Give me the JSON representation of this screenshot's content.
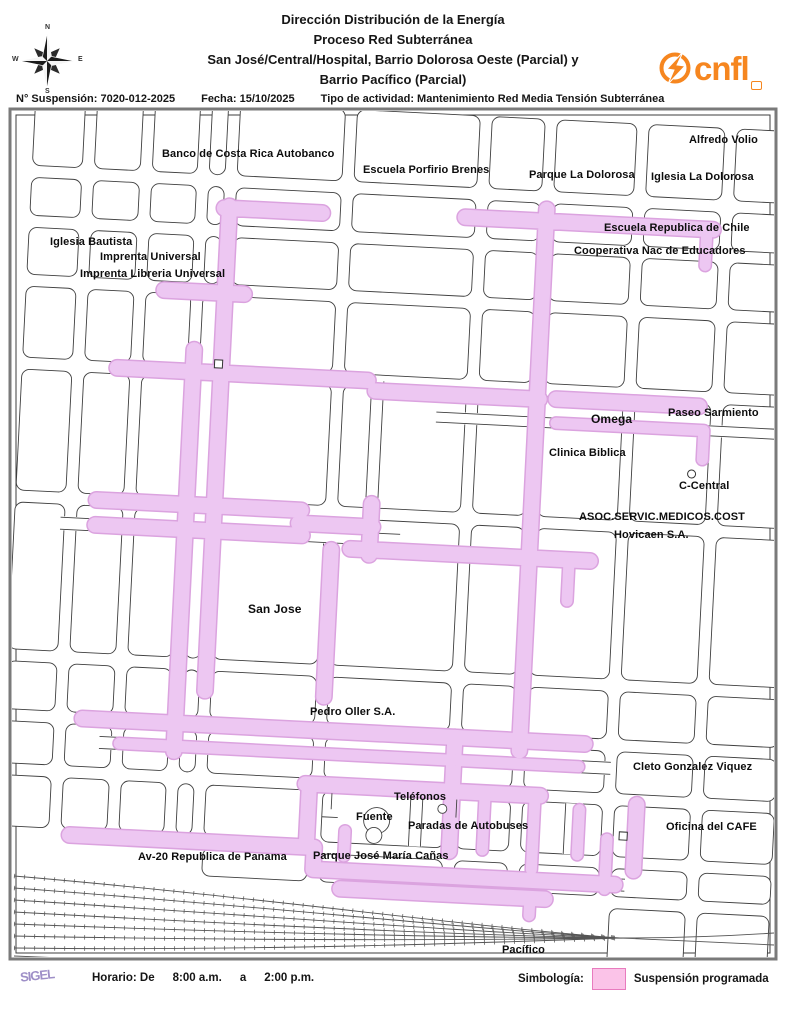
{
  "header": {
    "title_lines": [
      "Dirección Distribución de la Energía",
      "Proceso Red Subterránea",
      "San José/Central/Hospital, Barrio Dolorosa Oeste (Parcial) y",
      "Barrio Pacífico (Parcial)"
    ],
    "info": {
      "suspension": "N° Suspensión: 7020-012-2025",
      "fecha": "Fecha: 15/10/2025",
      "actividad": "Tipo de actividad: Mantenimiento Red Media Tensión Subterránea"
    },
    "logo_text": "cnfl",
    "compass": {
      "n": "N",
      "e": "E",
      "s": "S",
      "w": "W"
    }
  },
  "map": {
    "labels": [
      "Alfredo Volio",
      "Banco de Costa Rica Autobanco",
      "Escuela Porfirio Brenes",
      "Parque La Dolorosa",
      "Iglesia La Dolorosa",
      "Escuela Republica de Chile",
      "Cooperativa Nac de Educadores",
      "Iglesia Bautista",
      "Imprenta Universal",
      "Imprenta Libreria Universal",
      "Omega",
      "Paseo Sarmiento",
      "Clinica Biblica",
      "C-Central",
      "ASOC.SERVIC.MEDICOS.COST",
      "Hovicaen S.A.",
      "San Jose",
      "Pedro Oller S.A.",
      "Cleto Gonzalez Viquez",
      "Teléfonos",
      "Fuente",
      "Paradas de Autobuses",
      "Parque José María Cañas",
      "Av-20 Republica de Panama",
      "Oficina del CAFE",
      "Pacífico"
    ]
  },
  "footer": {
    "sigel": "SIGEL",
    "horario_label": "Horario: De",
    "horario_from": "8:00 a.m.",
    "horario_a": "a",
    "horario_to": "2:00 p.m.",
    "simbologia_label": "Simbología:",
    "legend_item": "Suspensión programada"
  },
  "colors": {
    "suspension_fill": "#EDC7F2",
    "suspension_outline": "#DBA3DF",
    "legend_swatch": "#FBC3E8",
    "legend_swatch_border": "#E87BBE",
    "cnfl_orange": "#F6861F",
    "street_line": "#3F3F3F"
  }
}
